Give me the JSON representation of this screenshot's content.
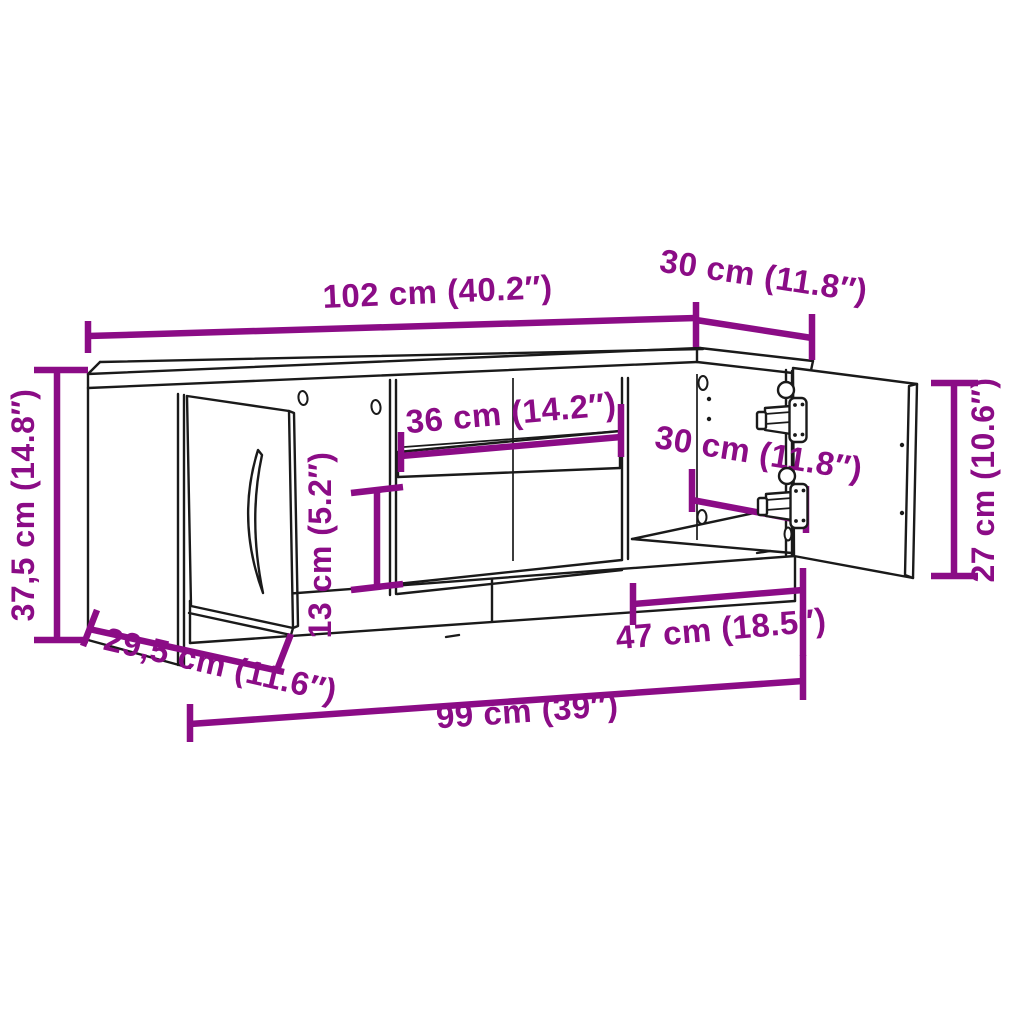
{
  "diagram": {
    "kind": "furniture-dimension-drawing",
    "subject": "TV cabinet with two doors and open middle shelf",
    "colors": {
      "dimension_accent": "#8B0C86",
      "outline": "#1a1a1a",
      "background": "#ffffff"
    },
    "dimensions": {
      "top_width": "102 cm (40.2″)",
      "top_depth": "30 cm (11.8″)",
      "overall_height": "37,5 cm (14.8″)",
      "shelf_width": "36 cm (14.2″)",
      "lower_gap_height": "13 cm (5.2″)",
      "inner_depth": "30 cm (11.8″)",
      "door_height": "27 cm (10.6″)",
      "base_depth": "29,5 cm (11.6″)",
      "right_section_width": "47 cm (18.5″)",
      "base_width": "99 cm (39″)"
    }
  }
}
